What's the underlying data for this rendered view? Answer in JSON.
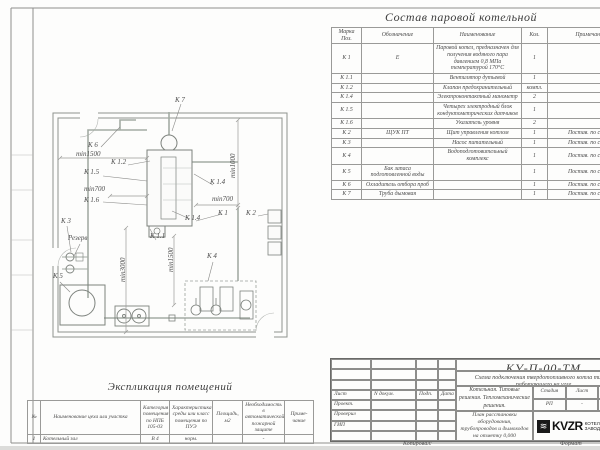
{
  "composition": {
    "title": "Состав паровой котельной",
    "headers": {
      "mark": "Марка Поз.",
      "designation": "Обозначение",
      "name": "Наименование",
      "qty": "Кол.",
      "note": "Примечания"
    },
    "rows": [
      {
        "mark": "К 1",
        "designation": "Е",
        "name": "Паровой котел, предназначен для получения водяного пара давлением 0,8 МПа температурой 170°С",
        "qty": "1",
        "note": ""
      },
      {
        "mark": "К 1.1",
        "designation": "",
        "name": "Вентилятор дутьевой",
        "qty": "1",
        "note": ""
      },
      {
        "mark": "К 1.2",
        "designation": "",
        "name": "Клапан предохранительный",
        "qty": "компл.",
        "note": ""
      },
      {
        "mark": "К 1.4",
        "designation": "",
        "name": "Электроконтактный манометр",
        "qty": "2",
        "note": ""
      },
      {
        "mark": "К 1.5",
        "designation": "",
        "name": "Четырех электродный блок кондуктометрических датчиков",
        "qty": "1",
        "note": ""
      },
      {
        "mark": "К 1.6",
        "designation": "",
        "name": "Указатель уровня",
        "qty": "2",
        "note": ""
      },
      {
        "mark": "К 2",
        "designation": "ЩУК ПТ",
        "name": "Щит управления котлом",
        "qty": "1",
        "note": "Постав. по соглас"
      },
      {
        "mark": "К 3",
        "designation": "",
        "name": "Насос питательный",
        "qty": "1",
        "note": "Постав. по соглас"
      },
      {
        "mark": "К 4",
        "designation": "",
        "name": "Водоподготовительный комплекс",
        "qty": "1",
        "note": "Постав. по соглас"
      },
      {
        "mark": "К 5",
        "designation": "Бак запаса подготовленной воды",
        "name": "",
        "qty": "1",
        "note": "Постав. по соглас"
      },
      {
        "mark": "К 6",
        "designation": "Охладитель отбора проб",
        "name": "",
        "qty": "1",
        "note": "Постав. по соглас"
      },
      {
        "mark": "К 7",
        "designation": "Труба дымовая",
        "name": "",
        "qty": "1",
        "note": "Постав. по соглас"
      }
    ]
  },
  "explication": {
    "title": "Экспликация помещений",
    "headers": [
      "№",
      "Наименование цеха или участка",
      "Категория помещения по НПБ 105-03",
      "Характеристика среды или класс помещения по ПУЭ",
      "Площадь, м2",
      "Необходимость в автоматической пожарной защите",
      "Приме- чание"
    ],
    "row1": {
      "num": "1",
      "name": "Котельный зал",
      "category": "В 4",
      "env": "норм.",
      "area": "",
      "fire": "-",
      "note": ""
    }
  },
  "title_block": {
    "doc_number": "КУ-П-00-ТМ",
    "description": "Схема подключения твердотопливного котла типа Е работающего на угле",
    "org_line": "Котельная. Типовые решения. Тепломеханические решения.",
    "plan_title": "План расстановки оборудования, трубопроводов и дымоходов на отметку 0,000",
    "stage_headers": {
      "stage": "Стадия",
      "sheet": "Лист",
      "sheets": "Листов"
    },
    "stage_values": {
      "stage": "РП",
      "sheet": "-",
      "sheets": "-"
    },
    "sign_headers": {
      "sheet": "Лист",
      "doc": "N докум.",
      "sign": "Подп.",
      "date": "Дата"
    },
    "roles": [
      "Проект.",
      "Проверил",
      "ГИП"
    ],
    "logo_word": "KVZR",
    "logo_caption1": "КОТЕЛЬН",
    "logo_caption2": "ЗАВОД Р",
    "copied_label": "Копировал:",
    "format_label": "Формат"
  },
  "plan": {
    "labels": {
      "k7": "К 7",
      "k6": "К 6",
      "min1500_a": "min1500",
      "k1_2": "К 1.2",
      "k1_5": "К 1.5",
      "min700_a": "min700",
      "k1_6": "К 1.6",
      "min1000": "min1000",
      "k1_4a": "К 1.4",
      "min700_b": "min700",
      "k1": "К 1",
      "k2": "К 2",
      "k1_4b": "К 1.4",
      "k3": "К 3",
      "rezerv": "Резерв",
      "k5": "К 5",
      "min3000": "min3000",
      "k1_1": "К 1.1",
      "min1500_b": "min1500",
      "k4": "К 4"
    }
  }
}
